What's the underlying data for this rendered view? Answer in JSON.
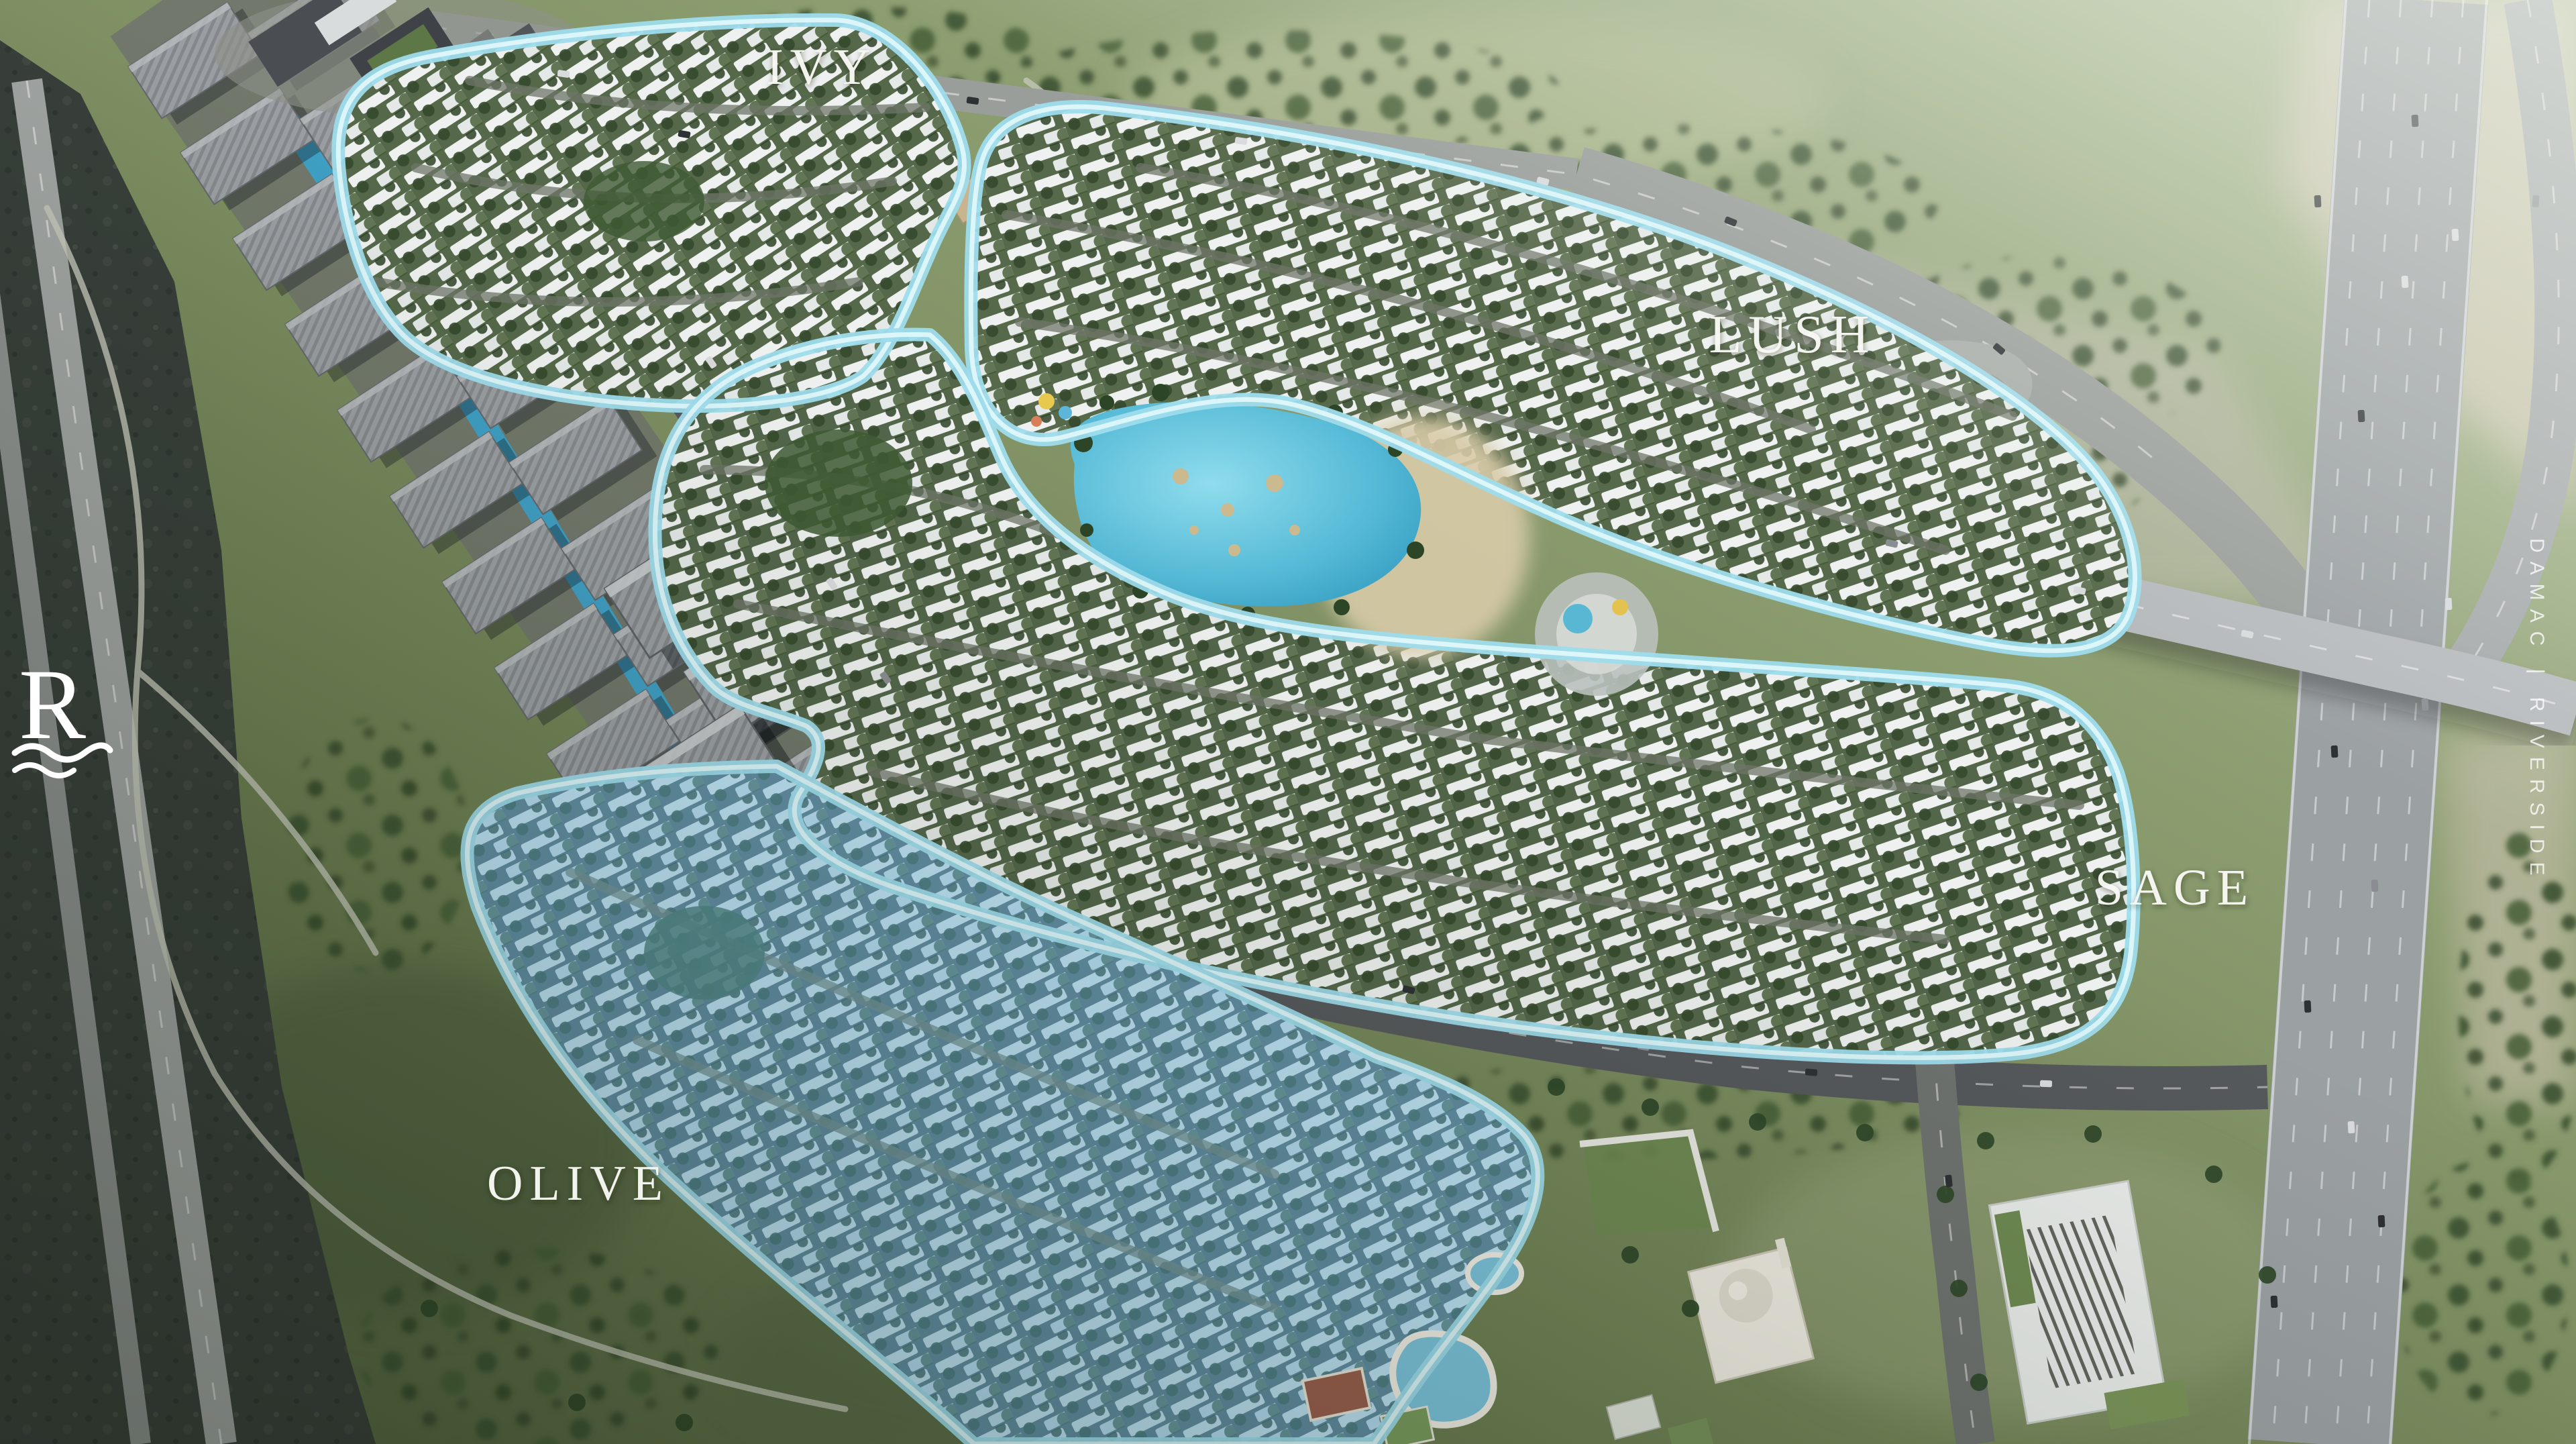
{
  "branding": {
    "logo_letter": "R",
    "vertical_watermark": "DAMAC | RIVERSIDE"
  },
  "zones": [
    {
      "id": "ivy",
      "label": "IVY",
      "highlighted": false
    },
    {
      "id": "lush",
      "label": "LUSH",
      "highlighted": false
    },
    {
      "id": "sage",
      "label": "SAGE",
      "highlighted": false
    },
    {
      "id": "olive",
      "label": "OLIVE",
      "highlighted": true
    }
  ],
  "colors": {
    "zone_outline": "#a6e6f2",
    "highlight_fill": "#7dc8e8",
    "lagoon": "#54b9d6",
    "label_text": "#ffffff"
  }
}
